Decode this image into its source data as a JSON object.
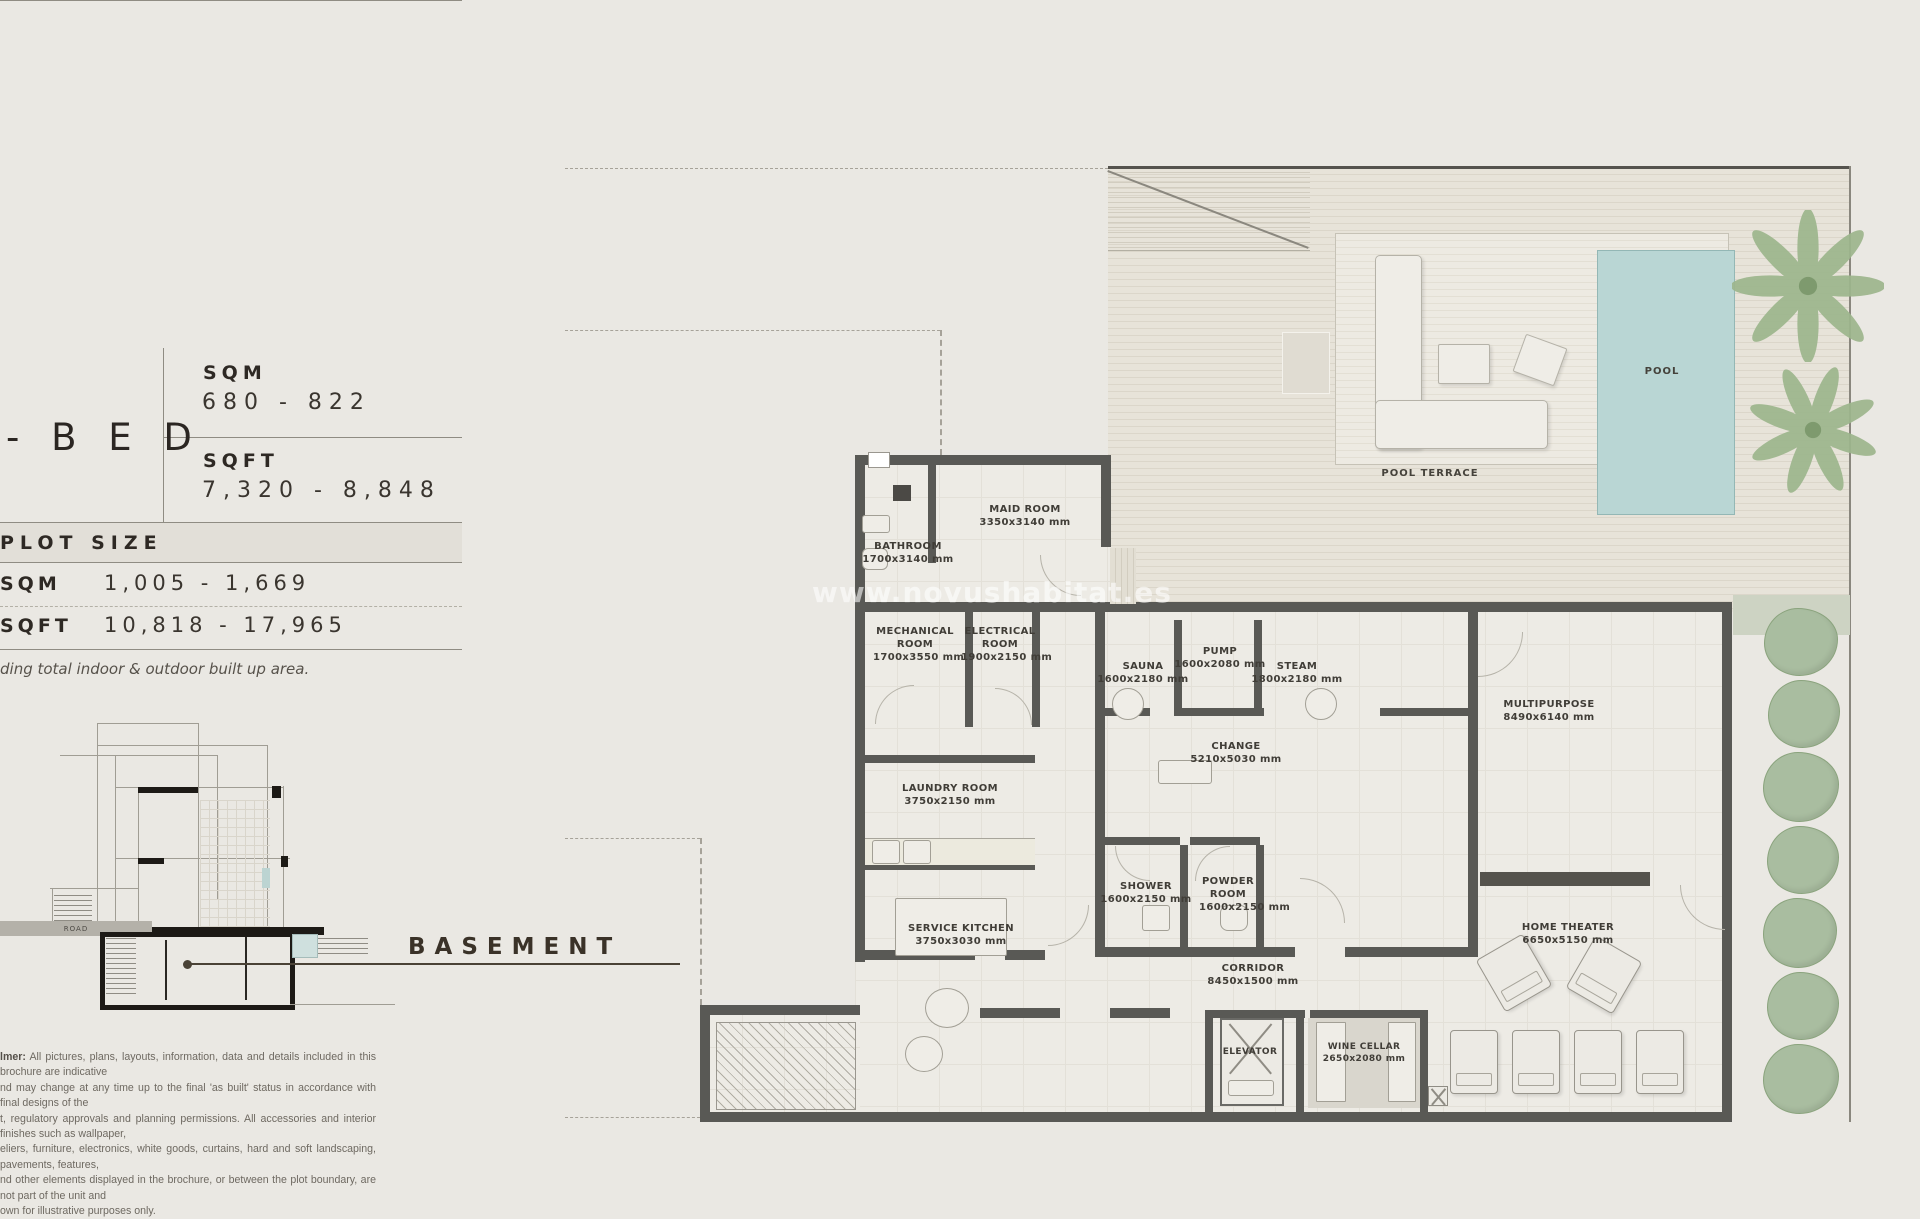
{
  "panel": {
    "bed_label": "- B E D",
    "size_table": {
      "sqm_label": "SQM",
      "sqm_value": "680 - 822",
      "sqft_label": "SQFT",
      "sqft_value": "7,320 - 8,848"
    },
    "plot": {
      "title": "PLOT SIZE",
      "sqm_label": "SQM",
      "sqm_value": "1,005 - 1,669",
      "sqft_label": "SQFT",
      "sqft_value": "10,818 - 17,965",
      "note": "ding total indoor & outdoor built up area."
    },
    "disclaimer": {
      "lead": "lmer:",
      "lines": [
        "All pictures, plans, layouts, information, data and details included in this brochure are indicative",
        "nd may change at any time up to the final 'as built' status in accordance with final designs of the",
        "t, regulatory approvals and planning permissions. All accessories and interior finishes such as wallpaper,",
        "eliers, furniture, electronics, white goods, curtains, hard and soft landscaping, pavements, features,",
        "nd other elements displayed in the brochure, or between the plot boundary, are not part of the unit and",
        "own for illustrative purposes only."
      ]
    }
  },
  "section": {
    "label": "BASEMENT",
    "road_label": "ROAD"
  },
  "watermark": "www.novushabitat.es",
  "floorplan": {
    "rooms": [
      {
        "name": "MAID ROOM",
        "dims": "3350x3140 mm"
      },
      {
        "name": "BATHROOM",
        "dims": "1700x3140 mm"
      },
      {
        "name": "MECHANICAL ROOM",
        "dims": "1700x3550 mm"
      },
      {
        "name": "ELECTRICAL ROOM",
        "dims": "1900x2150 mm"
      },
      {
        "name": "SAUNA",
        "dims": "1600x2180 mm"
      },
      {
        "name": "PUMP",
        "dims": "1600x2080 mm"
      },
      {
        "name": "STEAM",
        "dims": "1800x2180 mm"
      },
      {
        "name": "CHANGE",
        "dims": "5210x5030 mm"
      },
      {
        "name": "MULTIPURPOSE",
        "dims": "8490x6140 mm"
      },
      {
        "name": "LAUNDRY ROOM",
        "dims": "3750x2150 mm"
      },
      {
        "name": "SERVICE KITCHEN",
        "dims": "3750x3030 mm"
      },
      {
        "name": "SHOWER",
        "dims": "1600x2150 mm"
      },
      {
        "name": "POWDER ROOM",
        "dims": "1600x2150 mm"
      },
      {
        "name": "CORRIDOR",
        "dims": "8450x1500 mm"
      },
      {
        "name": "ELEVATOR",
        "dims": ""
      },
      {
        "name": "WINE CELLAR",
        "dims": "2650x2080 mm"
      },
      {
        "name": "HOME THEATER",
        "dims": "6650x5150 mm"
      }
    ],
    "outdoor": {
      "pool": "POOL",
      "pool_terrace": "POOL TERRACE"
    },
    "colors": {
      "pool": "#b9d6d4",
      "wall": "#595955",
      "hedge": "#a9bda0",
      "text": "#403d37"
    }
  }
}
